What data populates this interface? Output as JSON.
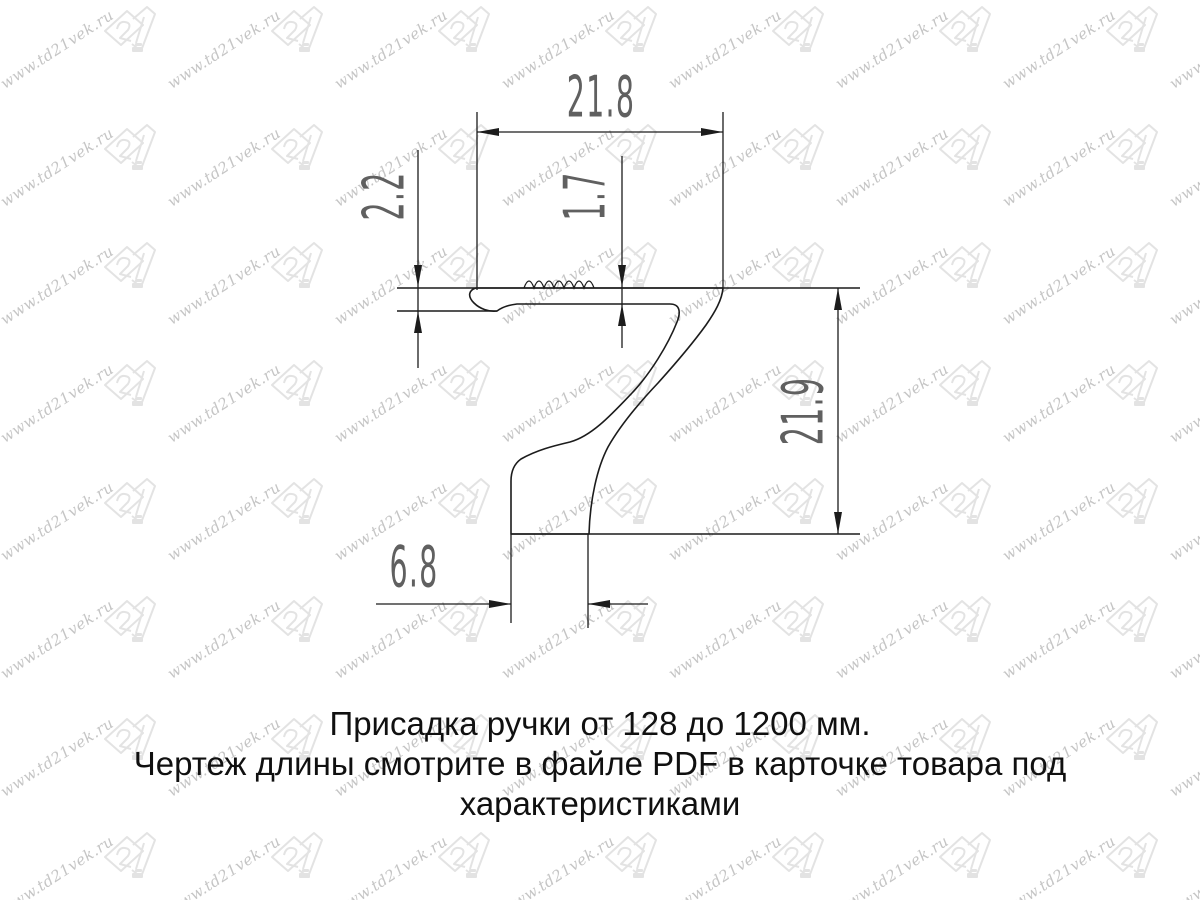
{
  "page": {
    "background": "#ffffff"
  },
  "watermark": {
    "text": "www.td21vek.ru",
    "logo_text": "21",
    "text_color": "#c5c5c5",
    "logo_color": "#e3e3e3"
  },
  "drawing": {
    "type": "technical-profile-cross-section",
    "subject": "furniture handle profile",
    "line_color": "#1c1c1c",
    "dim_text_color": "#606060",
    "dimensions": {
      "width_top": "21.8",
      "cap_thickness": "2.2",
      "plate_thickness": "1.7",
      "height": "21.9",
      "foot_width": "6.8"
    }
  },
  "caption": {
    "lines": [
      "Присадка ручки от 128 до 1200 мм.",
      "Чертеж длины смотрите в файле PDF в карточке товара под",
      "характеристиками"
    ]
  }
}
